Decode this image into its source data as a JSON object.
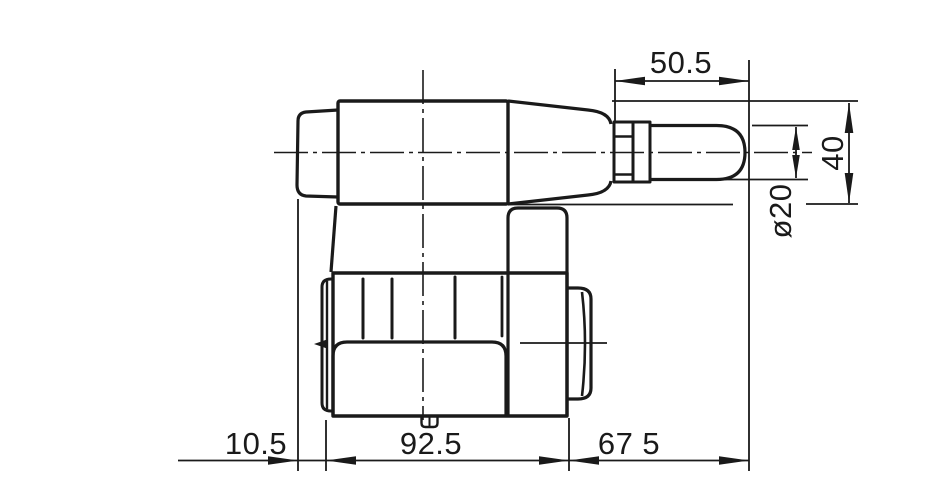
{
  "drawing": {
    "kind": "technical-line-drawing",
    "subject": "solenoid valve side view with dimensions",
    "background_color": "#ffffff",
    "line_color": "#1a1a1a",
    "dimensions": {
      "pin_length": "50.5",
      "coil_height": "40",
      "pin_diameter": "ø20",
      "left_offset": "10.5",
      "body_length": "92.5",
      "right_length": "67 5"
    }
  }
}
